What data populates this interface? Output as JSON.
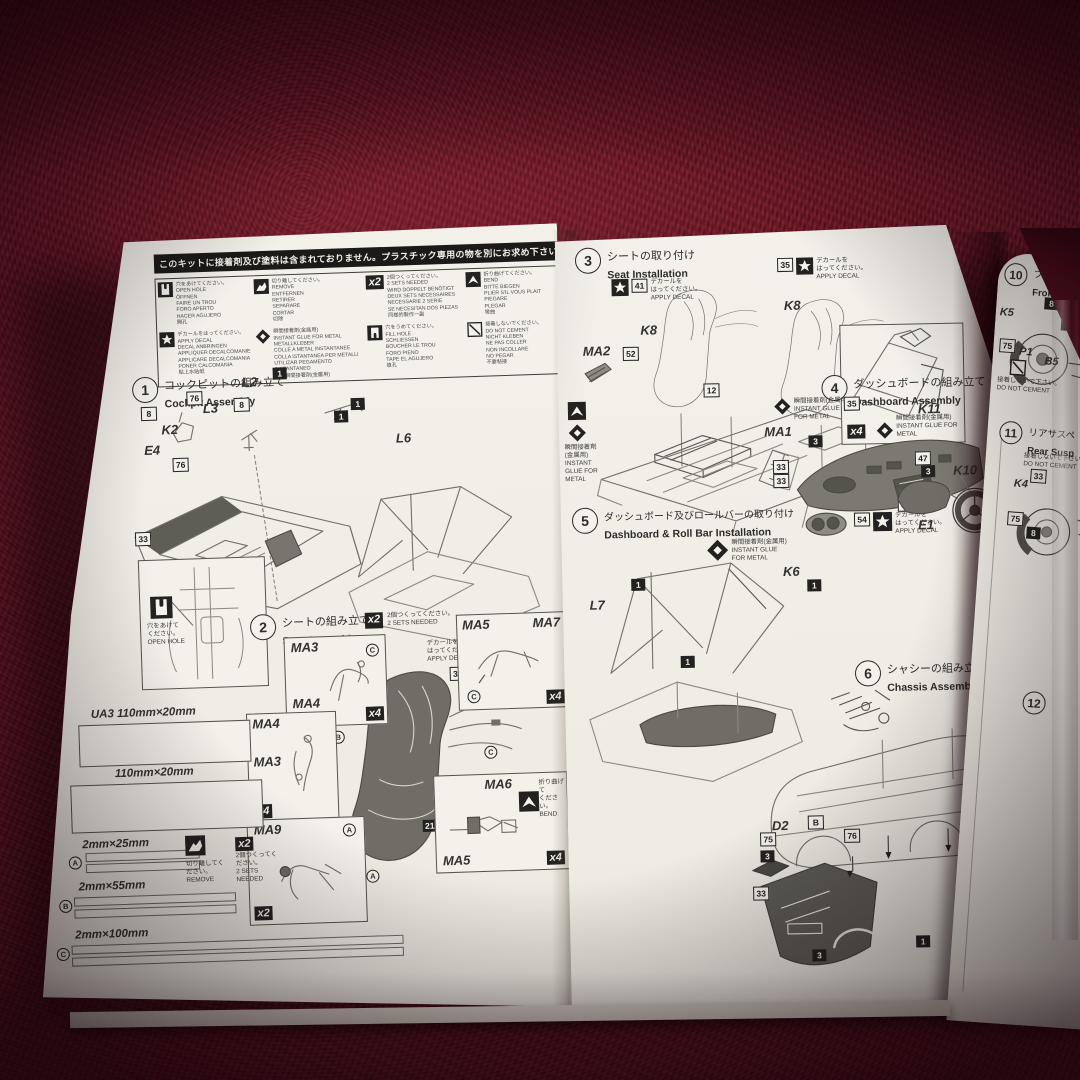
{
  "scene": {
    "fabric_color": "#6d1424",
    "paper_color": "#f3f1ea",
    "ink_color": "#2e2d2b"
  },
  "notice_bar": {
    "text": "このキットに接着剤及び塗料は含まれておりません。プラスチック専用の物を別にお求め下さい。"
  },
  "legend": {
    "open_hole": "穴をあけてください。\nOPEN HOLE\nÖFFNEN\nFAIRE UN TROU\nFORO APERTO\nHACER AGUJERO\n開孔",
    "remove": "切り離してください。\nREMOVE\nENTFERNEN\nRETIRER\nSEPARARE\nCORTAR\n切除",
    "x2_label": "x2",
    "x2": "2個つくってください。\n2 SETS NEEDED\nWIRD DOPPELT BENÖTIGT\nDEUX SETS NECESSAIRES\nNECESSARIE 2 SERIE\nSE NECESITAN DOS PIEZAS\n同様的製作一副",
    "bend": "折り曲げてください。\nBEND\nBITTE BIEGEN\nPLIER S'IL VOUS PLAIT\nPIEGARE\nPLEGAR\n彎曲",
    "apply_decal": "デカールをはってください。\nAPPLY DECAL\nDECAL ANBRINGEN\nAPPLIQUER DECALCOMANIE\nAPPLICARE DECALCOMANIA\nPONER CALCOMANIA\n貼上水貼紙",
    "instant_glue": "瞬間接着剤(金属用)\nINSTANT GLUE FOR METAL\nMETALLKLEBER\nCOLLE A METAL INSTANTANEE\nCOLLA ISTANTANEA PER METALLI\nUTILIZAR PEGAMENTO INSTANTANEO\n使用瞬間接著劑(金屬用)",
    "fill_hole": "穴をうめてください。\nFILL HOLE\nSCHLIESSEN\nBOUCHER LE TROU\nFORO PIENO\nTAPE EL AGUJERO\n填孔",
    "do_not_cement": "接着しないでください。\nDO NOT CEMENT\nNICHT KLEBEN\nNE PAS COLLER\nNON INCOLLARE\nNO PEGAR\n不要粘接"
  },
  "notes": {
    "open_hole_s": "穴をあけて\nください。\nOPEN HOLE",
    "x2_s": "2個つくってください。\n2 SETS NEEDED",
    "decal_s": "デカールを\nはってください。\nAPPLY DECAL",
    "bend_s": "折り曲げて\nください。\nBEND",
    "glue_s": "瞬間接着剤(金属用)\nINSTANT GLUE FOR METAL",
    "remove_s": "切り離してください。\nREMOVE",
    "dnc_s": "接着しないで下さい。\nDO NOT CEMENT"
  },
  "steps": {
    "s1": {
      "num": "1",
      "jp": "コックピットの組み立て",
      "en": "Cockpit Assembly",
      "parts": [
        "E4",
        "K2",
        "L3",
        "L2",
        "L6"
      ],
      "badges": [
        "76",
        "1",
        "8",
        "8",
        "1",
        "76",
        "33",
        "1"
      ]
    },
    "s2": {
      "num": "2",
      "jp": "シートの組み立て",
      "en": "Seat Assembly",
      "seat": "K1",
      "boxes": [
        {
          "a": "MA3",
          "b": "MA4",
          "count": "x4"
        },
        {
          "a": "MA5",
          "b": "MA7",
          "count": "x4"
        },
        {
          "a": "MA4",
          "b": "MA3",
          "count": "x4"
        },
        {
          "a": "MA9",
          "count": "x2"
        },
        {
          "a": "MA6",
          "b": "MA5",
          "count": "x4"
        }
      ],
      "letters": [
        "A",
        "B",
        "C"
      ],
      "badges": [
        "13",
        "21",
        "32"
      ]
    },
    "strips": {
      "ua3": "UA3  110mm×20mm",
      "r2": "110mm×20mm",
      "a": "2mm×25mm",
      "b": "2mm×55mm",
      "c": "2mm×100mm",
      "la": "A",
      "lb": "B",
      "lc": "C"
    },
    "s3": {
      "num": "3",
      "jp": "シートの取り付け",
      "en": "Seat Installation",
      "parts": [
        "MA2",
        "K8",
        "K8"
      ],
      "count": "x4",
      "badges": [
        "41",
        "35",
        "12",
        "52"
      ]
    },
    "s4": {
      "num": "4",
      "jp": "ダッシュボードの組み立て",
      "en": "Dashboard Assembly",
      "parts": [
        "MA1",
        "K11",
        "K10",
        "E1"
      ],
      "badge54": "54",
      "badges": [
        "35",
        "33",
        "47",
        "3",
        "33",
        "33",
        "3"
      ]
    },
    "s5": {
      "num": "5",
      "jp": "ダッシュボード及びロールバーの取り付け",
      "en": "Dashboard & Roll Bar Installation",
      "parts": [
        "L7",
        "K6"
      ],
      "badges": [
        "1",
        "1",
        "1"
      ]
    },
    "s6": {
      "num": "6",
      "jp": "シャシーの組み立て",
      "en": "Chassis Assembly",
      "parts": [
        "D2",
        "B1"
      ],
      "badges": [
        "B",
        "75",
        "3",
        "76",
        "33",
        "3",
        "1"
      ]
    },
    "s10": {
      "num": "10",
      "jp": "フロントサスペンシ",
      "en": "Front Suspensio",
      "parts": [
        "K5",
        "P1",
        "B5"
      ],
      "badges": [
        "8",
        "2",
        "75"
      ]
    },
    "s11": {
      "num": "11",
      "jp": "リアサスペ",
      "en": "Rear Susp",
      "parts": [
        "K4"
      ],
      "badges": [
        "33",
        "75",
        "8"
      ]
    },
    "s12": {
      "num": "12"
    }
  }
}
